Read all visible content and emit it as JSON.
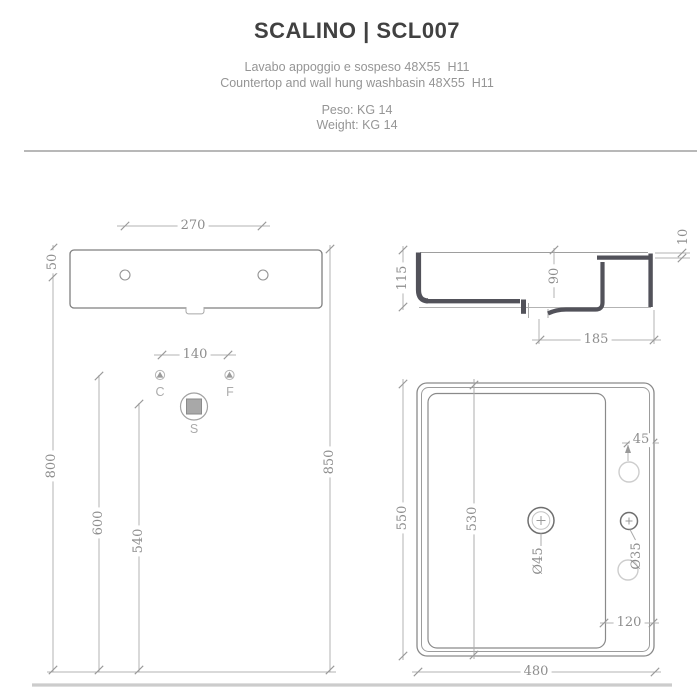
{
  "header": {
    "title": "SCALINO | SCL007",
    "subtitle_it": "Lavabo appoggio e sospeso 48X55  H11",
    "subtitle_en": "Countertop and wall hung washbasin 48X55  H11",
    "weight_it": "Peso: KG 14",
    "weight_en": "Weight: KG 14"
  },
  "front_view": {
    "dims": {
      "w270": "270",
      "h50": "50",
      "w140": "140",
      "h800": "800",
      "h600": "600",
      "h540": "540",
      "h850": "850"
    },
    "symbols": {
      "hot": "C",
      "cold": "F",
      "drain": "S"
    }
  },
  "side_view": {
    "dims": {
      "h115": "115",
      "h90": "90",
      "t10": "10",
      "w185": "185"
    }
  },
  "top_view": {
    "dims": {
      "d550": "550",
      "d530": "530",
      "w480": "480",
      "off45": "45",
      "off120": "120",
      "drain_diameter": "Ø45",
      "tap_diameter": "Ø35"
    }
  },
  "colors": {
    "title_text": "#414141",
    "subtitle_text": "#959595",
    "dim_text": "#8d8d8d",
    "thin_line": "#b3b3b3",
    "outline": "#8a8a8a",
    "profile_dark": "#52525a",
    "option_hole_gray": "#cdcdcd",
    "floor_line": "#cccccc"
  }
}
